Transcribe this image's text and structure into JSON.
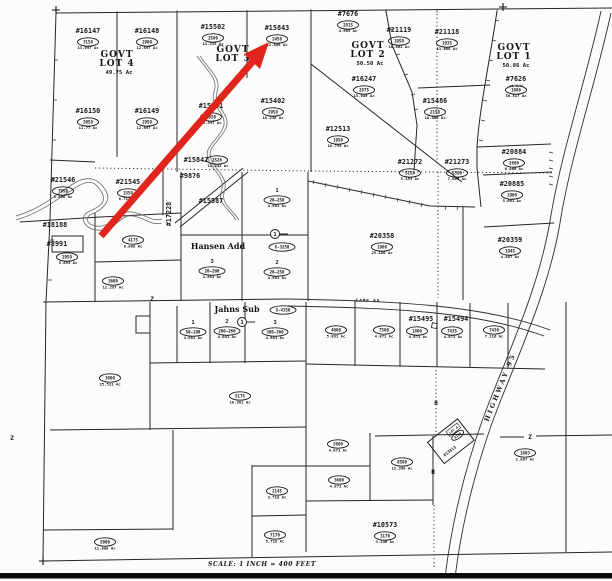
{
  "map": {
    "scale_label": "SCALE: 1 INCH = 400 FEET",
    "arrow_color": "#e0251c",
    "arrow": {
      "x1": 101,
      "y1": 236,
      "x2": 254,
      "y2": 60,
      "tip": "269,42 260,69 244,54"
    },
    "govt_lots": [
      {
        "line1": "GOVT",
        "line2": "LOT 4",
        "acreage": "49.75 Ac",
        "x": 117,
        "y": 57
      },
      {
        "line1": "GOVT",
        "line2": "LOT 3",
        "acreage": "",
        "x": 233,
        "y": 52
      },
      {
        "line1": "GOVT",
        "line2": "LOT 2",
        "acreage": "50.50 Ac",
        "x": 368,
        "y": 48
      },
      {
        "line1": "GOVT",
        "line2": "LOT 1",
        "acreage": "50.86 Ac",
        "x": 514,
        "y": 50
      }
    ],
    "parcels": [
      {
        "n": "#16147",
        "t": "3150",
        "a": "13.097 Ac",
        "x": 88,
        "y": 33
      },
      {
        "n": "#16148",
        "t": "2900",
        "a": "12.897 Ac",
        "x": 147,
        "y": 33
      },
      {
        "n": "#15502",
        "t": "2500",
        "a": "13.333 Ac",
        "x": 213,
        "y": 29
      },
      {
        "n": "#15843",
        "t": "2450",
        "a": "13.888 Ac",
        "x": 277,
        "y": 30
      },
      {
        "n": "#7676",
        "t": "2815",
        "a": "4.985 Ac",
        "x": 348,
        "y": 16
      },
      {
        "n": "#21119",
        "t": "1950",
        "a": "10.001 Ac",
        "x": 399,
        "y": 32
      },
      {
        "n": "#21118",
        "t": "1935",
        "a": "13.688 Ac",
        "x": 447,
        "y": 34
      },
      {
        "n": "#7626",
        "t": "1006",
        "a": "56.817 Ac",
        "x": 516,
        "y": 81,
        "sub": "pt S/W"
      },
      {
        "n": "#16150",
        "t": "3050",
        "a": "11.77 Ac",
        "x": 88,
        "y": 113
      },
      {
        "n": "#16149",
        "t": "2950",
        "a": "12.897 Ac",
        "x": 147,
        "y": 113
      },
      {
        "n": "#15501",
        "t": "2850",
        "a": "15.397 Ac",
        "x": 211,
        "y": 108
      },
      {
        "n": "#15402",
        "t": "2950",
        "a": "18.238 Ac",
        "x": 273,
        "y": 103
      },
      {
        "n": "#16247",
        "t": "2875",
        "a": "15.049 Ac",
        "x": 364,
        "y": 81
      },
      {
        "n": "#12513",
        "t": "1950",
        "a": "18.759 Ac",
        "x": 338,
        "y": 131
      },
      {
        "n": "#15486",
        "t": "2150",
        "a": "10.008 Ac",
        "x": 435,
        "y": 103
      },
      {
        "n": "#20884",
        "t": "2600",
        "a": "6.066 Ac",
        "x": 514,
        "y": 154
      },
      {
        "n": "#21272",
        "t": "5150",
        "a": "5.155 Ac",
        "x": 410,
        "y": 164
      },
      {
        "n": "#21273",
        "t": "5350",
        "a": "7.065 Ac",
        "x": 457,
        "y": 164
      },
      {
        "n": "#20885",
        "t": "1900",
        "a": "5.001 Ac",
        "x": 512,
        "y": 186
      },
      {
        "n": "#20359",
        "t": "1945",
        "a": "4.887 Ac",
        "x": 510,
        "y": 242
      },
      {
        "n": "#20358",
        "t": "1900",
        "a": "25.186 Ac",
        "x": 382,
        "y": 238
      },
      {
        "n": "#21546",
        "t": "7950",
        "a": "5.696 Ac",
        "x": 63,
        "y": 182
      },
      {
        "n": "#21545",
        "t": "3350",
        "a": "6.712 Ac",
        "x": 128,
        "y": 184
      },
      {
        "n": "#18188",
        "x": 55,
        "y": 227
      },
      {
        "n": "#8991",
        "t": "2950",
        "a": "5.693 Ac",
        "x": 57,
        "y": 246,
        "ox": 67,
        "oy": 257,
        "ax": 68,
        "ay": 264
      },
      {
        "n": "#9876",
        "x": 190,
        "y": 178
      },
      {
        "n": "#15842",
        "t": "2526",
        "a": "11.242 Ac",
        "x": 196,
        "y": 162,
        "ox": 217,
        "oy": 160,
        "ax": 218,
        "ay": 167
      },
      {
        "n": "#15987",
        "x": 211,
        "y": 203
      },
      {
        "n": "#17228",
        "x": 171,
        "y": 214,
        "rot": -90
      },
      {
        "n": "#15495",
        "t": "1800",
        "a": "4.871 Ac",
        "x": 421,
        "y": 321,
        "ox": 417,
        "oy": 331,
        "ax": 418,
        "ay": 338
      },
      {
        "n": "#15494",
        "t": "7435",
        "a": "4.871 Ac",
        "x": 456,
        "y": 321,
        "ox": 452,
        "oy": 331,
        "ax": 453,
        "ay": 338
      },
      {
        "n": "#10573",
        "t": "3170",
        "a": "3.246 Ac",
        "x": 385,
        "y": 527
      }
    ],
    "tax_lots": [
      {
        "t": "4175",
        "a": "8.888 Ac",
        "x": 133,
        "y": 240
      },
      {
        "t": "3600",
        "a": "12.297 Ac",
        "x": 113,
        "y": 281
      },
      {
        "t": "3800",
        "a": "25.511 Ac",
        "x": 110,
        "y": 378
      },
      {
        "t": "5175",
        "a": "10.981 Ac",
        "x": 240,
        "y": 396
      },
      {
        "t": "4000",
        "a": "5.891 Ac",
        "x": 336,
        "y": 330
      },
      {
        "t": "7500",
        "a": "4.871 Ac",
        "x": 384,
        "y": 330
      },
      {
        "t": "7436",
        "a": "7.116 Ac",
        "x": 494,
        "y": 330
      },
      {
        "t": "2600",
        "a": "4.871 Ac",
        "x": 338,
        "y": 444
      },
      {
        "t": "8500",
        "a": "13.398 Ac",
        "x": 402,
        "y": 462
      },
      {
        "t": "3600",
        "a": "4.871 Ac",
        "x": 339,
        "y": 480
      },
      {
        "t": "2145",
        "a": "3.718 Ac",
        "x": 277,
        "y": 491
      },
      {
        "t": "7170",
        "a": "5.718 Ac",
        "x": 275,
        "y": 535
      },
      {
        "t": "5000",
        "a": "11.888 Ac",
        "x": 105,
        "y": 542
      },
      {
        "t": "1803",
        "a": "2.887 Ac",
        "x": 525,
        "y": 453
      }
    ],
    "subdivisions": [
      {
        "name": "Hansen Add",
        "x": 218,
        "y": 249,
        "oval": "X-3250",
        "oval_x": 282,
        "oval_y": 247,
        "lots": [
          {
            "num": "1",
            "oval": "20–250",
            "acreage": "4.881 Ac",
            "x": 277,
            "y": 192
          },
          {
            "num": "2",
            "oval": "20–250",
            "acreage": "4.881 Ac",
            "x": 277,
            "y": 264
          },
          {
            "num": "3",
            "oval": "20–200",
            "acreage": "4.881 Ac",
            "x": 212,
            "y": 263
          }
        ]
      },
      {
        "name": "Jahns Sub",
        "x": 237,
        "y": 312,
        "oval": "X-4350",
        "oval_x": 283,
        "oval_y": 310,
        "lots": [
          {
            "num": "1",
            "oval": "50–100",
            "acreage": "4.881 Ac",
            "x": 193,
            "y": 324
          },
          {
            "num": "2",
            "oval": "200–260",
            "acreage": "4.881 Ac",
            "x": 227,
            "y": 323
          },
          {
            "num": "3",
            "oval": "300–360",
            "acreage": "4.881 Ac",
            "x": 275,
            "y": 324
          }
        ]
      }
    ],
    "roads": [
      {
        "name": "HIGHWAY 95",
        "x": 502,
        "y": 388,
        "rotation": -68,
        "size": "lg"
      },
      {
        "name": "CAMP RD",
        "x": 368,
        "y": 302,
        "rotation": 1,
        "size": "sm"
      }
    ],
    "road_markers": [
      {
        "num": "1",
        "x": 275,
        "y": 234
      },
      {
        "num": "1",
        "x": 242,
        "y": 322
      }
    ],
    "rotated_parcel": {
      "number": "#13813",
      "tax": "8105",
      "lot": "LOT A",
      "x": 452,
      "y": 441,
      "rotation": -38
    },
    "letters": [
      {
        "t": "Z",
        "x": 152,
        "y": 301
      },
      {
        "t": "Z",
        "x": 530,
        "y": 439
      },
      {
        "t": "Z",
        "x": 12,
        "y": 440
      },
      {
        "t": "H",
        "x": 436,
        "y": 405
      },
      {
        "t": "H",
        "x": 433,
        "y": 474
      }
    ],
    "corner_crosses": [
      {
        "x": 56,
        "y": 10
      },
      {
        "x": 503,
        "y": 7
      },
      {
        "x": 43,
        "y": 561
      }
    ]
  }
}
